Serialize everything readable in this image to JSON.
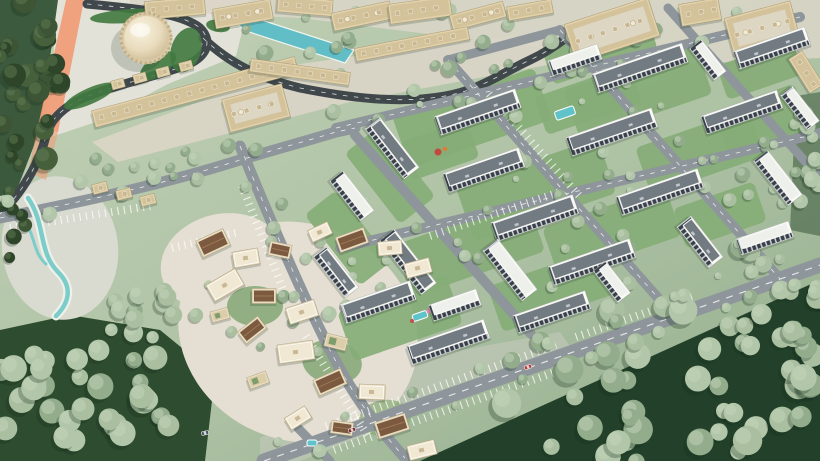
{
  "meta": {
    "description": "Aerial 3D architectural rendering of a master-planned community: a domed landmark with souk-style retail buildings and a teal canal at the top left, a rotated grid of white apartment blocks with courtyards and pools on the right, a winding traditional village cluster at the bottom left, and dense forest at the bottom right, all connected by gray roads with parking bays and a few cars.",
    "canvas": {
      "w": 820,
      "h": 461
    }
  },
  "palette": {
    "grass_a": "#c0cfb4",
    "grass_b": "#9eb697",
    "forest_floor": "#2e4c30",
    "forest_floor_dark": "#22402a",
    "road_light": "#8e969b",
    "road_dark": "#40484c",
    "plaza": "#d9d5c6",
    "plaza_light": "#e3e2d8",
    "sand": "#e4dfd2",
    "tan_wall": "#e2d2ab",
    "tan_roof": "#d3c29a",
    "white_wall": "#fbfbf8",
    "roof_dark": "#737b82",
    "roof_light": "#eef0ec",
    "window_dark": "#39404a",
    "brown_roof": "#7b5a40",
    "teal": "#5fc3c9",
    "canal": "#62bec6",
    "orange": "#f09d78",
    "hedge": "#40793f",
    "lawn": "#86ad77",
    "tree_sage": [
      "#a9bfa0",
      "#93ad8c",
      "#b2c6a9"
    ],
    "tree_dark": [
      "#3d5534",
      "#2f4529",
      "#46603c"
    ],
    "car_red": "#b73730"
  },
  "scene": {
    "plazas": [
      [
        "54,0 250,0 236,56 168,84 96,122 42,140 54,64",
        "plaza_light",
        1
      ],
      [
        "92,142 300,64 470,40 575,32 585,58 350,102 118,162",
        "plaza",
        0.95
      ],
      [
        "130,0 820,0 820,58 686,64 556,50 300,18 130,10",
        "plaza",
        0.9
      ],
      [
        "260,438 430,356 560,332 574,352 300,461 260,461",
        "#c6cbbd",
        0.55
      ]
    ],
    "forest": [
      [
        "420,461 820,280 820,461",
        "forest_floor_dark",
        1
      ],
      [
        "0,330 70,315 160,330 215,375 205,461 0,461",
        "forest_floor",
        1
      ],
      [
        "0,0 58,0 40,130 16,192 0,196",
        "forest_floor",
        0.9
      ],
      [
        "796,96 820,92 820,236 790,230",
        "forest_floor",
        0.5
      ]
    ],
    "sand": [
      [
        298,
        332,
        122,
        108,
        24,
        "sand",
        1
      ],
      [
        222,
        262,
        62,
        48,
        -14,
        "sand",
        1
      ],
      [
        60,
        248,
        58,
        72,
        -8,
        "#d9dad0",
        1
      ],
      [
        255,
        306,
        28,
        20,
        0,
        "#7da26f",
        0.8
      ],
      [
        332,
        362,
        30,
        22,
        10,
        "#7da26f",
        0.8
      ],
      [
        385,
        418,
        26,
        18,
        -8,
        "#87a973",
        0.7
      ]
    ],
    "lawns": [
      [
        472,
        118,
        -19,
        150,
        55
      ],
      [
        638,
        92,
        -19,
        140,
        52
      ],
      [
        536,
        190,
        -19,
        150,
        58
      ],
      [
        700,
        152,
        -19,
        120,
        50
      ],
      [
        470,
        248,
        -19,
        140,
        55
      ],
      [
        612,
        232,
        -19,
        130,
        52
      ],
      [
        400,
        318,
        -19,
        115,
        52
      ],
      [
        552,
        290,
        -19,
        120,
        48
      ],
      [
        720,
        215,
        -19,
        85,
        42
      ],
      [
        762,
        120,
        -19,
        85,
        48
      ],
      [
        390,
        175,
        52,
        90,
        45
      ],
      [
        348,
        238,
        52,
        90,
        40
      ],
      [
        600,
        50,
        -19,
        110,
        36
      ],
      [
        760,
        70,
        -19,
        80,
        36
      ],
      [
        440,
        150,
        -19,
        70,
        40
      ],
      [
        588,
        100,
        -19,
        100,
        40
      ]
    ],
    "orange": [
      [
        "66,0 84,0 58,132 38,126",
        0.95
      ],
      [
        "38,126 58,132 46,180 28,172",
        0.6
      ]
    ],
    "roads": [
      [
        "M 87,4 C 130,8 180,12 200,28 C 214,42 206,58 184,66 C 150,78 118,84 86,97 C 62,107 50,120 46,136 C 42,152 30,185 0,214",
        9,
        1,
        1
      ],
      [
        "M 203,38 C 230,64 260,78 300,88 C 350,98 400,104 445,96 C 480,90 500,74 530,60 C 545,53 558,44 566,38",
        9,
        1,
        1
      ],
      [
        "M 264,461 L 820,265",
        15,
        1,
        0
      ],
      [
        "M 336,128 L 800,17",
        10,
        1,
        0
      ],
      [
        "M 340,248 L 820,133",
        10,
        1,
        0
      ],
      [
        "M 448,60 L 674,316",
        10,
        1,
        0
      ],
      [
        "M 560,30 L 780,279",
        10,
        1,
        0
      ],
      [
        "M 668,8 L 820,178",
        9,
        0,
        0
      ],
      [
        "M 240,146 C 270,220 300,290 330,350 C 355,400 380,430 405,458",
        11,
        1,
        0
      ],
      [
        "M 0,218 C 90,200 160,185 240,160 C 280,148 310,140 336,132 L 355,128",
        11,
        1,
        0
      ],
      [
        "M 355,135 L 531,334",
        10,
        0,
        0
      ],
      [
        "M 298,428 L 330,461",
        9,
        0,
        0
      ],
      [
        "M 448,60 L 560,30",
        9,
        0,
        0
      ]
    ],
    "parking": [
      [
        326,
        426,
        556,
        345
      ],
      [
        334,
        450,
        564,
        369
      ],
      [
        576,
        337,
        696,
        295
      ],
      [
        10,
        228,
        150,
        206
      ],
      [
        242,
        186,
        284,
        292
      ],
      [
        306,
        336,
        368,
        436
      ],
      [
        172,
        248,
        238,
        232
      ],
      [
        430,
        236,
        560,
        192
      ],
      [
        489,
        94,
        582,
        199
      ]
    ],
    "hedges": [
      [
        130,
        16,
        40,
        7,
        -4
      ],
      [
        186,
        50,
        15,
        23,
        18
      ],
      [
        90,
        96,
        28,
        8,
        -24
      ],
      [
        158,
        66,
        21,
        10,
        -35
      ],
      [
        218,
        26,
        12,
        6,
        10
      ]
    ],
    "canal_points": "230,18 243,14 354,50 345,63 246,31",
    "lagoon": [
      [
        "M 28,198 C 46,224 38,252 58,272 C 74,288 68,304 56,316",
        "#eef1e9",
        9
      ],
      [
        "M 28,198 C 46,224 38,252 58,272 C 74,288 68,304 56,316",
        "#7ccdc9",
        4.5
      ],
      [
        "M 22,218 C 36,234 32,252 46,264",
        "#7ccdc9",
        3
      ]
    ],
    "pools": [
      [
        565,
        113,
        -19,
        20,
        9
      ],
      [
        683,
        187,
        -19,
        18,
        8
      ],
      [
        420,
        316,
        -19,
        15,
        7
      ],
      [
        312,
        443,
        0,
        10,
        6
      ]
    ],
    "dots": [
      [
        438,
        152,
        3.5,
        "#c2493f"
      ],
      [
        445,
        149,
        2.2,
        "#e07b35"
      ],
      [
        429,
        311,
        2.5,
        "#df8ab0"
      ],
      [
        412,
        321,
        2,
        "#c4504a"
      ],
      [
        447,
        9,
        2.6,
        "#c2403a"
      ],
      [
        453,
        12,
        1.8,
        "#4a7ec2"
      ],
      [
        323,
        448,
        3,
        "#6cc5c8"
      ]
    ],
    "tree_clusters": [
      [
        31,
        85,
        34,
        95,
        26,
        1,
        6,
        12,
        11
      ],
      [
        12,
        225,
        14,
        38,
        7,
        1,
        5,
        8,
        22
      ],
      [
        85,
        400,
        100,
        62,
        30,
        0,
        8,
        14,
        33
      ],
      [
        150,
        315,
        52,
        52,
        14,
        0,
        6,
        10,
        44
      ],
      [
        300,
        305,
        95,
        85,
        11,
        0,
        4,
        7,
        55
      ],
      [
        660,
        385,
        168,
        82,
        46,
        0,
        8,
        15,
        66
      ],
      [
        770,
        292,
        58,
        58,
        17,
        0,
        7,
        12,
        77
      ],
      [
        806,
        162,
        17,
        72,
        12,
        0,
        5,
        9,
        88
      ],
      [
        450,
        42,
        225,
        36,
        24,
        0,
        4,
        8,
        99
      ],
      [
        150,
        158,
        58,
        22,
        8,
        0,
        4,
        7,
        111
      ],
      [
        580,
        190,
        230,
        120,
        26,
        0,
        3,
        6,
        122
      ]
    ],
    "tree_rows": [
      [
        336,
        120,
        780,
        12,
        12,
        9,
        7
      ],
      [
        348,
        256,
        812,
        146,
        14,
        10,
        8
      ],
      [
        282,
        452,
        790,
        272,
        16,
        11,
        9
      ],
      [
        454,
        64,
        666,
        304,
        9,
        10,
        10
      ],
      [
        566,
        34,
        772,
        266,
        9,
        10,
        12
      ],
      [
        10,
        210,
        232,
        158,
        7,
        9,
        13
      ],
      [
        246,
        154,
        330,
        346,
        8,
        11,
        14
      ]
    ],
    "tops": [
      [
        175,
        8,
        -5,
        60,
        18,
        0
      ],
      [
        243,
        14,
        -10,
        58,
        20,
        1
      ],
      [
        305,
        6,
        5,
        55,
        16,
        0
      ],
      [
        362,
        16,
        -12,
        60,
        18,
        1
      ],
      [
        420,
        10,
        -8,
        62,
        20,
        0
      ],
      [
        478,
        16,
        -15,
        55,
        16,
        1
      ],
      [
        530,
        10,
        -10,
        45,
        14,
        0
      ],
      [
        612,
        30,
        -18,
        88,
        40,
        1
      ],
      [
        700,
        12,
        -10,
        40,
        22,
        0
      ],
      [
        762,
        28,
        -15,
        68,
        38,
        1
      ],
      [
        806,
        72,
        58,
        40,
        16,
        0
      ]
    ],
    "souk": [
      [
        195,
        92,
        -15,
        210,
        17
      ],
      [
        300,
        72,
        8,
        100,
        13
      ],
      [
        412,
        44,
        -11,
        115,
        13
      ],
      [
        256,
        108,
        -15,
        62,
        34
      ]
    ],
    "kiosks": [
      [
        118,
        84
      ],
      [
        140,
        78
      ],
      [
        163,
        72
      ],
      [
        186,
        66
      ]
    ],
    "tan_small": [
      [
        100,
        188
      ],
      [
        124,
        194
      ],
      [
        148,
        200
      ]
    ],
    "residential": [
      [
        478,
        112,
        -19,
        85,
        20,
        1
      ],
      [
        640,
        68,
        -19,
        95,
        20,
        1
      ],
      [
        772,
        48,
        -19,
        75,
        19,
        1
      ],
      [
        575,
        60,
        -19,
        52,
        16,
        0
      ],
      [
        392,
        148,
        52,
        64,
        19,
        1
      ],
      [
        484,
        170,
        -19,
        80,
        20,
        1
      ],
      [
        612,
        132,
        -19,
        90,
        20,
        1
      ],
      [
        742,
        112,
        -19,
        80,
        19,
        1
      ],
      [
        800,
        108,
        52,
        44,
        15,
        0
      ],
      [
        408,
        262,
        52,
        68,
        19,
        1
      ],
      [
        535,
        218,
        -19,
        86,
        20,
        1
      ],
      [
        660,
        192,
        -19,
        86,
        20,
        1
      ],
      [
        778,
        178,
        52,
        56,
        18,
        0
      ],
      [
        378,
        302,
        -19,
        74,
        20,
        1
      ],
      [
        510,
        270,
        52,
        64,
        19,
        0
      ],
      [
        592,
        262,
        -19,
        86,
        20,
        1
      ],
      [
        700,
        242,
        52,
        52,
        18,
        1
      ],
      [
        765,
        238,
        -19,
        55,
        17,
        0
      ],
      [
        448,
        342,
        -19,
        82,
        20,
        1
      ],
      [
        552,
        312,
        -19,
        76,
        19,
        1
      ],
      [
        612,
        282,
        52,
        40,
        16,
        0
      ],
      [
        352,
        196,
        52,
        50,
        17,
        0
      ],
      [
        336,
        272,
        52,
        52,
        17,
        1
      ],
      [
        455,
        305,
        -19,
        50,
        17,
        0
      ],
      [
        708,
        60,
        52,
        40,
        15,
        0
      ]
    ],
    "village": [
      [
        213,
        243,
        -25,
        30,
        18,
        1
      ],
      [
        246,
        258,
        -10,
        26,
        16,
        0
      ],
      [
        280,
        250,
        12,
        22,
        14,
        1
      ],
      [
        225,
        285,
        -30,
        34,
        19,
        0
      ],
      [
        264,
        296,
        0,
        24,
        15,
        1
      ],
      [
        302,
        312,
        -18,
        30,
        17,
        0
      ],
      [
        252,
        330,
        -38,
        26,
        15,
        1
      ],
      [
        296,
        352,
        -8,
        36,
        19,
        0
      ],
      [
        336,
        342,
        14,
        22,
        13,
        2
      ],
      [
        330,
        382,
        -24,
        30,
        17,
        1
      ],
      [
        372,
        392,
        2,
        26,
        15,
        0
      ],
      [
        392,
        426,
        -18,
        32,
        17,
        1
      ],
      [
        298,
        418,
        -32,
        24,
        14,
        0
      ],
      [
        342,
        428,
        8,
        22,
        13,
        1
      ],
      [
        422,
        450,
        -14,
        28,
        15,
        0
      ],
      [
        258,
        380,
        -20,
        20,
        12,
        2
      ],
      [
        220,
        315,
        -15,
        18,
        11,
        2
      ],
      [
        352,
        240,
        -20,
        30,
        16,
        1
      ],
      [
        390,
        248,
        -5,
        24,
        14,
        0
      ],
      [
        418,
        268,
        -15,
        26,
        15,
        0
      ],
      [
        320,
        232,
        -25,
        22,
        13,
        0
      ]
    ],
    "cars": [
      [
        528,
        367,
        -19,
        "#b73730"
      ],
      [
        352,
        430,
        -19,
        "#7e2a2a"
      ],
      [
        205,
        433,
        -14,
        "#4a5560"
      ]
    ],
    "dome": {
      "cx": 146,
      "cy": 38,
      "r": 23
    }
  }
}
